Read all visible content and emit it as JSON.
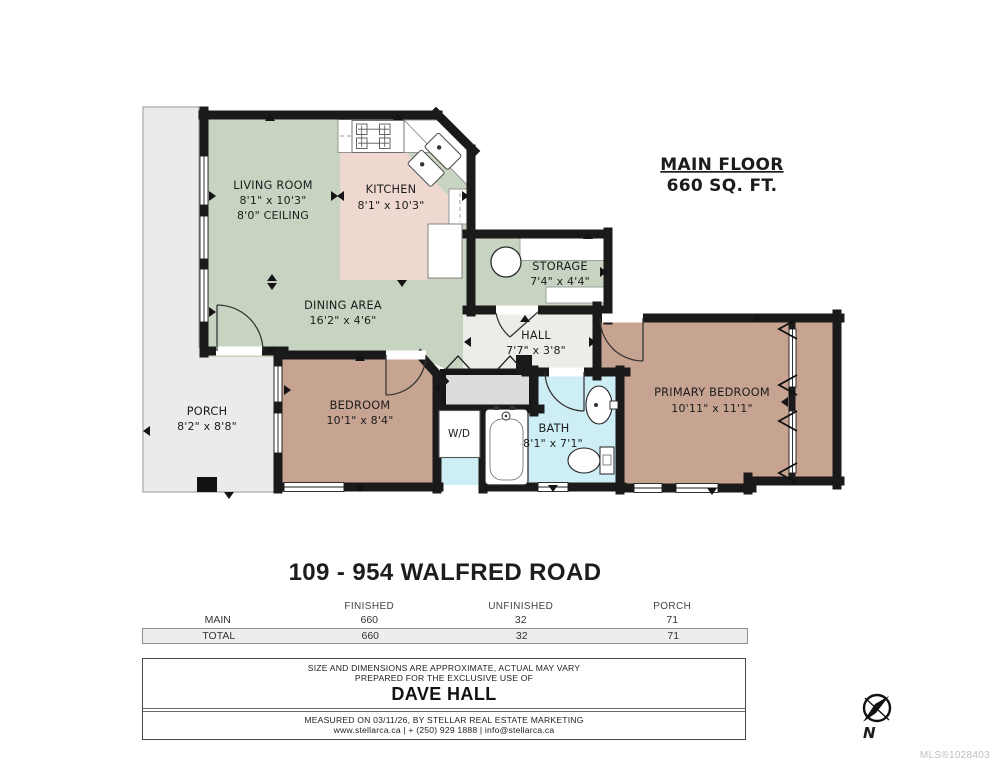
{
  "plan": {
    "header": {
      "title": "MAIN FLOOR",
      "area": "660 SQ. FT."
    },
    "rooms": [
      {
        "name": "LIVING ROOM",
        "dims": "8'1\" x 10'3\"",
        "note": "8'0\" CEILING"
      },
      {
        "name": "KITCHEN",
        "dims": "8'1\" x 10'3\""
      },
      {
        "name": "DINING AREA",
        "dims": "16'2\" x 4'6\""
      },
      {
        "name": "STORAGE",
        "dims": "7'4\" x 4'4\""
      },
      {
        "name": "HALL",
        "dims": "7'7\" x 3'8\""
      },
      {
        "name": "PRIMARY BEDROOM",
        "dims": "10'11\" x 11'1\""
      },
      {
        "name": "BEDROOM",
        "dims": "10'1\" x 8'4\""
      },
      {
        "name": "BATH",
        "dims": "8'1\" x 7'1\""
      },
      {
        "name": "PORCH",
        "dims": "8'2\" x 8'8\""
      },
      {
        "name": "W/D"
      }
    ],
    "compass_label": "N"
  },
  "address": "109 - 954 WALFRED ROAD",
  "area_table": {
    "columns": [
      "FINISHED",
      "UNFINISHED",
      "PORCH"
    ],
    "rows": [
      {
        "label": "MAIN",
        "values": [
          "660",
          "32",
          "71"
        ]
      },
      {
        "label": "TOTAL",
        "values": [
          "660",
          "32",
          "71"
        ]
      }
    ]
  },
  "footer": {
    "disclaimer": "SIZE AND DIMENSIONS ARE APPROXIMATE, ACTUAL MAY VARY",
    "prepared_for": "PREPARED FOR THE EXCLUSIVE USE OF",
    "client": "DAVE HALL",
    "measured": "MEASURED ON 03/11/26, BY STELLAR REAL ESTATE MARKETING",
    "contact": "www.stellarca.ca | + (250) 929 1888 | info@stellarca.ca"
  },
  "watermark": "MLS®1028403",
  "colors": {
    "walls": "#1a1a1a",
    "living_dining": "#c8d4c2",
    "kitchen": "#efd8cf",
    "storage": "#c8d4c2",
    "hall": "#ebede9",
    "bedroom": "#c7a391",
    "primary_bedroom": "#c7a391",
    "bath": "#cdeef5",
    "wd_cell": "#cdeef5",
    "porch": "#ebebeb",
    "closet": "#dcdcdc"
  }
}
